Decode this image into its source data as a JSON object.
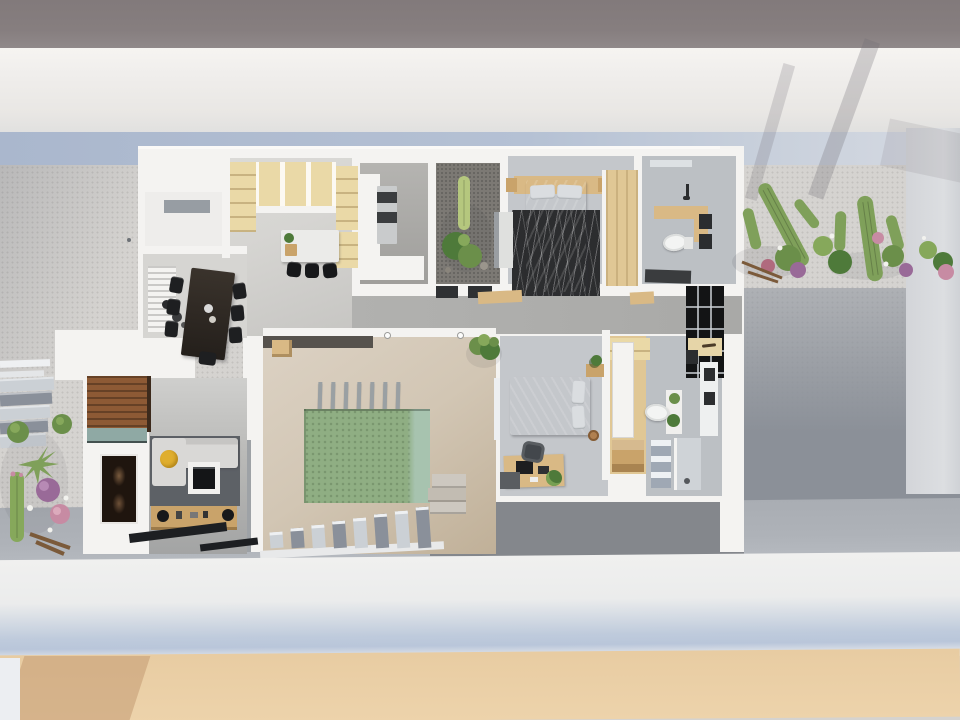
{
  "scene": {
    "title": "Top-down 3D architectural rendering of a narrow single-storey house with central courtyard plunge pool",
    "view": "top-down axonometric render",
    "visible_text": "none"
  },
  "palette": {
    "road": "#867e7f",
    "walk": "#f0eeec",
    "shadow_blue": "#b5c1d4",
    "gravel": "#d5d3d0",
    "gravel_dot": "#c3c1be",
    "gravel_dark": "#8b9098",
    "wall_strip": "#d3d5d9",
    "house_wall": "#f4f3f1",
    "floor_light": "#d6d5d2",
    "floor_gray": "#c4c7cb",
    "floor_bath": "#bcc0c4",
    "floor_dark": "#9f9e9b",
    "lightwell": "#7c7974",
    "hall": "#a9a9a7",
    "court_tile": "#d2c6b4",
    "pool": "#8fae83",
    "pool_light": "#a7c3af",
    "terrace": "#84878c",
    "concrete": "#aeb2b8",
    "bottom_wall": "#ebecec",
    "bottom_shadow": "#bfcbdc",
    "sand": "#e8cca2",
    "sand_shadow": "#c79f77",
    "wood_tan": "#ead9a7",
    "wood_mid": "#d9b985",
    "wood_deep": "#c9a36a",
    "wood_brown": "#8d5a35",
    "wardrobe": "#e0c795",
    "teal": "#8fa9a4",
    "sofa": "#d9d8d6",
    "rug": "#5d6166",
    "rug_black": "#2c2d2f",
    "bed_gray": "#a9afb5",
    "bed2_gray": "#9aa0a7",
    "pillow": "#dadde0",
    "marble": "#ebebe9",
    "black": "#17181a",
    "steel": "#131415",
    "appliance": "#c9cbcc",
    "yellow": "#dfae2e",
    "green": "#4e7a3a",
    "green_mid": "#6b8f4a",
    "green_light": "#86a85b",
    "cactus": "#7fa05a",
    "cactus_pale": "#b5c77e",
    "purple": "#996a98",
    "pink": "#c78ba3",
    "step_light": "#cbd0d5",
    "step_dark": "#8a909a",
    "art_dark": "#1f150e",
    "art_brown": "#7a5b3e"
  },
  "exterior": {
    "street": {
      "label": "street / road band"
    },
    "front_boundary": {
      "label": "white boundary wall with blue shadow"
    },
    "front_yard": {
      "label": "light gravel front yard"
    },
    "side_garden": {
      "label": "desert garden with saguaro cacti and flowering shrubs"
    },
    "left_garden": {
      "label": "succulent and cactus bed"
    },
    "entry_steps": {
      "label": "exterior entry steps",
      "step_count": 5
    },
    "rear_boundary": {
      "label": "rear white wall"
    },
    "rear_ground": {
      "label": "sand strip"
    }
  },
  "rooms": [
    {
      "id": "entry",
      "label": "entry vestibule",
      "furniture": [
        "skylight"
      ]
    },
    {
      "id": "dining",
      "label": "dining room",
      "furniture": [
        "dark-wood-dining-table",
        "dining-chairs x7",
        "louvered-sideboard",
        "decor-bowls"
      ]
    },
    {
      "id": "kitchen",
      "label": "kitchen",
      "furniture": [
        "tan-wall-cabinets",
        "tall-cabinet",
        "pantry-shelves",
        "marble-island",
        "bar-stools x3",
        "herb-plant"
      ]
    },
    {
      "id": "laundry",
      "label": "laundry / pantry",
      "furniture": [
        "l-shaped-counter",
        "stacked-washer-dryer"
      ]
    },
    {
      "id": "lightwell",
      "label": "interior cactus lightwell",
      "furniture": [
        "column-cactus",
        "shrub",
        "gravel-bed"
      ]
    },
    {
      "id": "bedroom-1",
      "label": "main bedroom",
      "furniture": [
        "double-bed",
        "headboard-shelf",
        "nightstands x2",
        "patterned-rug",
        "tall-cabinet",
        "wardrobe"
      ]
    },
    {
      "id": "bathroom-1",
      "label": "bathroom 1",
      "furniture": [
        "timber-vanity",
        "toilet",
        "mirrors",
        "shower",
        "bath-mat",
        "window"
      ]
    },
    {
      "id": "hallway",
      "label": "hallway",
      "furniture": [
        "steel-glass-partition",
        "doormats"
      ]
    },
    {
      "id": "living",
      "label": "living room",
      "furniture": [
        "sectional-sofa",
        "yellow-cushion",
        "area-rug",
        "tv-unit",
        "timber-credenza",
        "wood-slat-feature-wall",
        "teal-shelf",
        "framed-artwork",
        "dark-floor-mats"
      ]
    },
    {
      "id": "courtyard",
      "label": "central courtyard",
      "furniture": [
        "plunge-pool",
        "pergola-posts x7",
        "concrete-steps x8",
        "planter-blocks",
        "potted-plant",
        "shade-strip",
        "wood-stool"
      ]
    },
    {
      "id": "bedroom-2",
      "label": "bedroom 2",
      "furniture": [
        "double-bed",
        "nightstand",
        "plant",
        "round-stool",
        "desk",
        "monitor",
        "laptop",
        "office-chair",
        "storage-box",
        "desk-plant"
      ]
    },
    {
      "id": "closet-2",
      "label": "walk-in closet",
      "furniture": [
        "wardrobe",
        "white-panels",
        "drawers",
        "hanger-niche"
      ]
    },
    {
      "id": "bathroom-2",
      "label": "bathroom 2",
      "furniture": [
        "vanity",
        "sinks x2",
        "toilet",
        "counter-plants",
        "towel-stack",
        "shower"
      ]
    }
  ],
  "counts": {
    "bedrooms": 2,
    "bathrooms": 2,
    "pergola_posts": 7,
    "entry_steps": 5,
    "courtyard_steps": 8,
    "bar_stools": 3,
    "dining_chairs": 7
  }
}
